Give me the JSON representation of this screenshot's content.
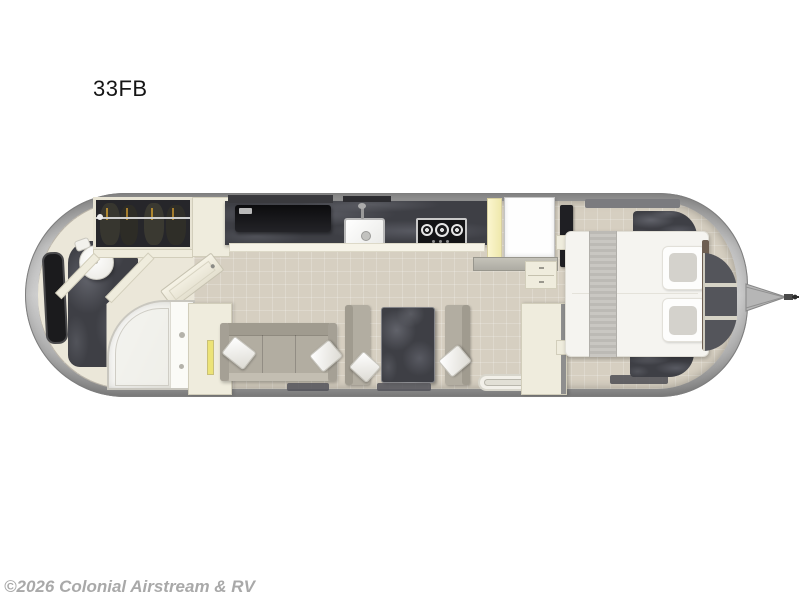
{
  "page": {
    "background": "#ffffff"
  },
  "floorplan": {
    "model": "33FB",
    "watermark": "©2026 Colonial Airstream & RV"
  },
  "colors": {
    "title_text": "#151515",
    "watermark_text": "#a9a9a9",
    "shell_edge": "#7e7e7e",
    "floor_beige": "#d6cfc1",
    "bath_floor": "#ebe7d9",
    "marble_dark": "#3e3f45",
    "cabinet_cream": "#efecdd",
    "cream_line": "#d2cebb",
    "accent_yellow": "#ece377",
    "upholstery": "#b2ada1",
    "window_black": "#1b1b1d",
    "bed_white": "#f5f4f0"
  }
}
